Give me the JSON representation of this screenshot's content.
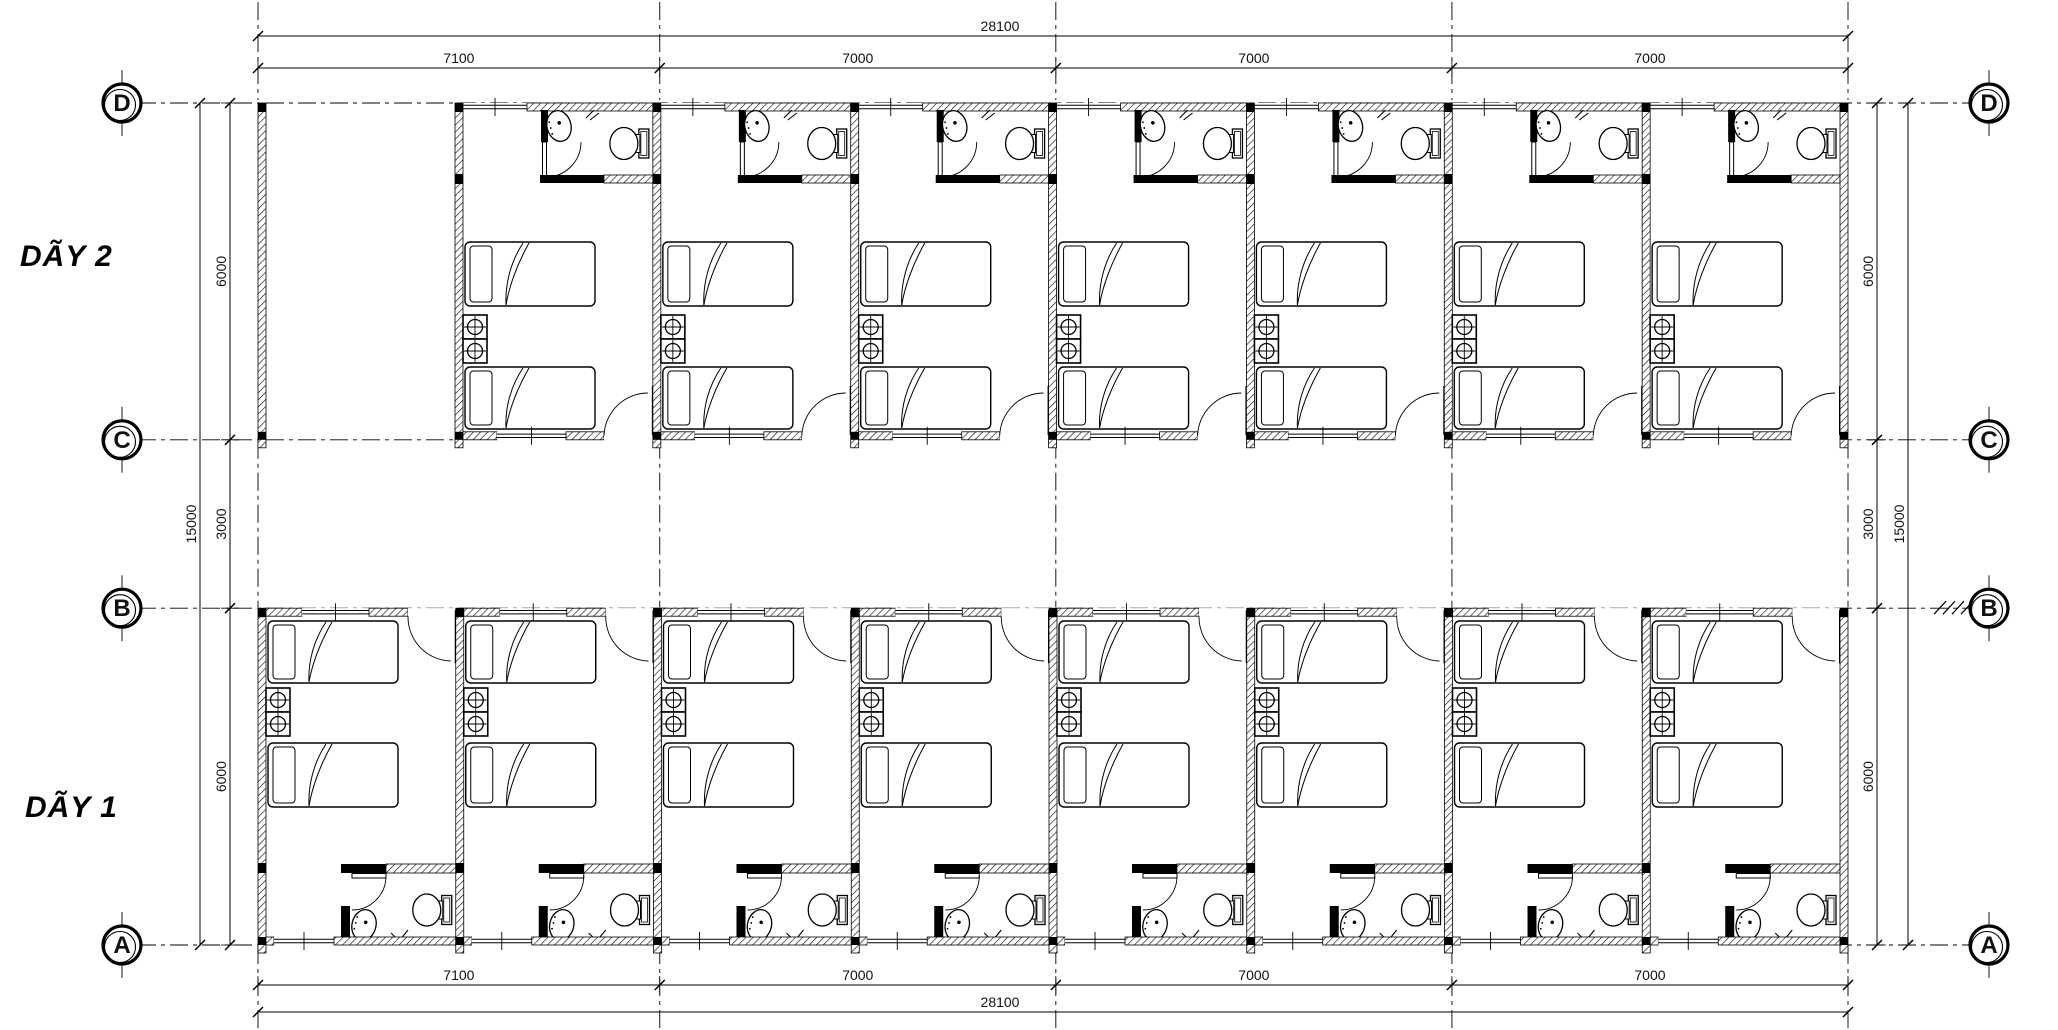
{
  "page": {
    "background": "#ffffff",
    "line_color": "#000000",
    "text_color": "#111111",
    "drawing_type": "architectural-floor-plan"
  },
  "row_labels": {
    "row2": "DÃY 2",
    "row1": "DÃY 1"
  },
  "grid": {
    "row_lines": [
      {
        "label": "D",
        "mm": 0
      },
      {
        "label": "C",
        "mm": 6000
      },
      {
        "label": "B",
        "mm": 9000
      },
      {
        "label": "A",
        "mm": 15000
      }
    ],
    "column_lines_mm": [
      0,
      7100,
      14100,
      21100,
      28100
    ],
    "bubble_sides": [
      "left",
      "right"
    ],
    "break_hash_marks_at": "B-right"
  },
  "dimensions": {
    "top": {
      "total": "28100",
      "segments": [
        "7100",
        "7000",
        "7000",
        "7000"
      ]
    },
    "bottom": {
      "total": "28100",
      "segments": [
        "7100",
        "7000",
        "7000",
        "7000"
      ]
    },
    "left": {
      "total": "15000",
      "segments": [
        "6000",
        "3000",
        "6000"
      ]
    },
    "right": {
      "total": "15000",
      "segments": [
        "6000",
        "3000",
        "6000"
      ]
    }
  },
  "building": {
    "rows": [
      {
        "id": "day2",
        "label": "DÃY 2",
        "between_grids": [
          "D",
          "C"
        ],
        "unit_count": 7,
        "has_open_left_bay": true
      },
      {
        "id": "day1",
        "label": "DÃY 1",
        "between_grids": [
          "B",
          "A"
        ],
        "unit_count": 8,
        "has_open_left_bay": false
      }
    ],
    "unit_icons": [
      "bed-icon",
      "bed-icon",
      "stove-icon",
      "sink-icon",
      "toilet-icon",
      "door-swing-icon",
      "window-icon"
    ]
  }
}
